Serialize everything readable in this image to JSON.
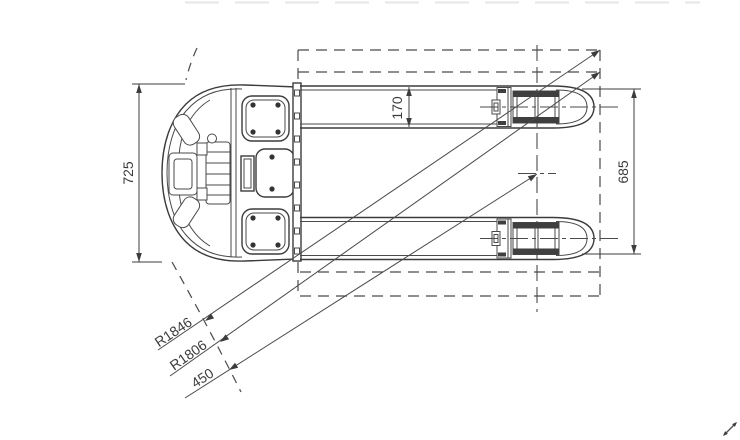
{
  "drawing": {
    "kind": "pallet-truck-top-view-technical-drawing",
    "dims": {
      "d725": "725",
      "d170": "170",
      "d685": "685",
      "r1846": "R1846",
      "r1806": "R1806",
      "d450": "450"
    },
    "colors": {
      "line": "#3c3c3c",
      "background": "#ffffff"
    },
    "icons": {
      "resize_cursor": "diagonal-resize-arrow"
    }
  }
}
